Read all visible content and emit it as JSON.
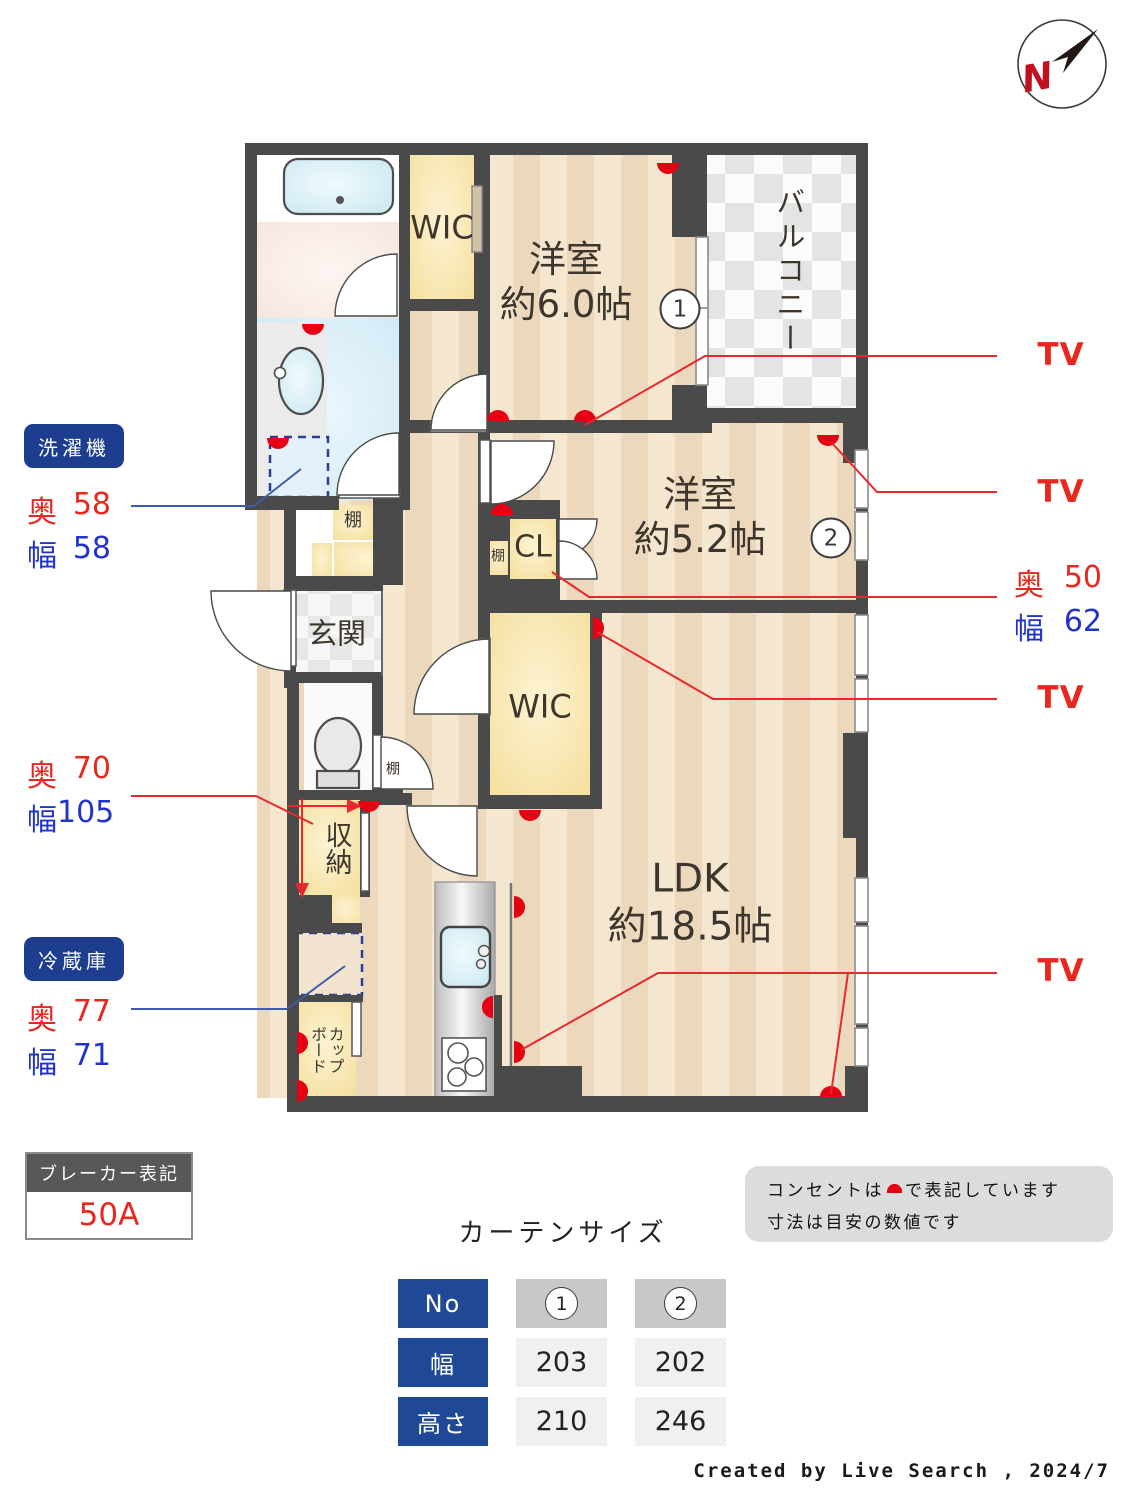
{
  "compass": {
    "north_label": "N"
  },
  "plan": {
    "labels": {
      "wic_top": "WIC",
      "room1_name": "洋室",
      "room1_size": "約6.0帖",
      "balcony": "バルコニー",
      "room2_name": "洋室",
      "room2_size": "約5.2帖",
      "cl": "CL",
      "wic_ldk": "WIC",
      "genkan": "玄関",
      "shuno": "収納",
      "ldk_name": "LDK",
      "ldk_size": "約18.5帖",
      "cupboard_line1": "カップ",
      "cupboard_line2": "ボード",
      "shelf_entry": "棚",
      "shelf_cl": "棚",
      "shelf_hall": "棚",
      "marker1": "1",
      "marker2": "2"
    }
  },
  "annotations": {
    "washer": {
      "badge": "洗濯機",
      "rows": [
        {
          "label": "奥",
          "value": "58"
        },
        {
          "label": "幅",
          "value": "58"
        }
      ]
    },
    "closet": {
      "rows": [
        {
          "label": "奥",
          "value": "70"
        },
        {
          "label": "幅",
          "value": "105"
        }
      ]
    },
    "fridge": {
      "badge": "冷蔵庫",
      "rows": [
        {
          "label": "奥",
          "value": "77"
        },
        {
          "label": "幅",
          "value": "71"
        }
      ]
    },
    "cl_dims": {
      "rows": [
        {
          "label": "奥",
          "value": "50"
        },
        {
          "label": "幅",
          "value": "62"
        }
      ]
    },
    "tv1": "TV",
    "tv2": "TV",
    "tv3": "TV",
    "tv4": "TV"
  },
  "breaker": {
    "title": "ブレーカー表記",
    "value": "50A"
  },
  "curtain_table": {
    "title": "カーテンサイズ",
    "header_label": "No",
    "columns": [
      "1",
      "2"
    ],
    "rows": [
      {
        "label": "幅",
        "values": [
          "203",
          "202"
        ]
      },
      {
        "label": "高さ",
        "values": [
          "210",
          "246"
        ]
      }
    ]
  },
  "notes": {
    "line1_prefix": "コンセントは",
    "line1_suffix": "で表記しています",
    "line2": "寸法は目安の数値です"
  },
  "footer": {
    "credit": "Created by Live Search , 2024/7"
  },
  "colors": {
    "accent_red": "#e8281e",
    "accent_blue": "#2233cc",
    "badge_navy": "#1d3e8f",
    "table_navy": "#1f4896",
    "wall": "#4a4a4a"
  }
}
